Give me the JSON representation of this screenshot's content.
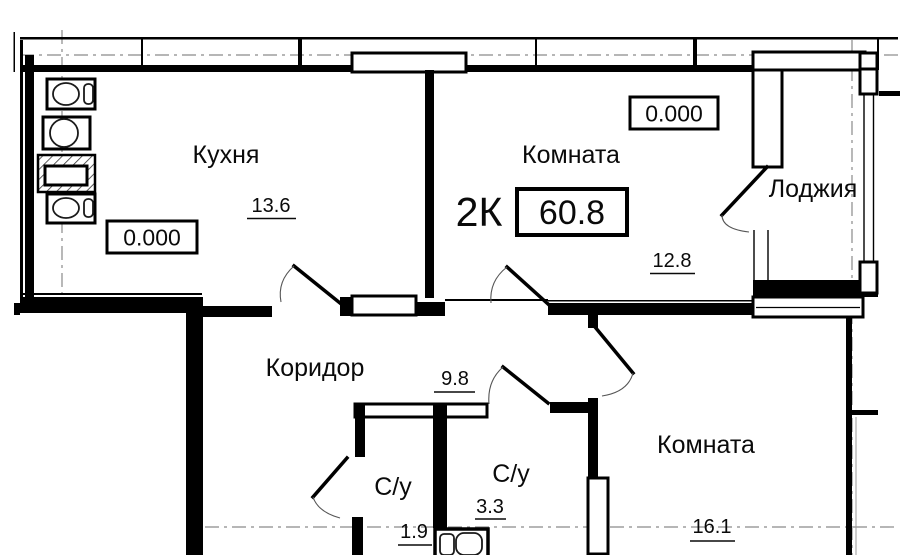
{
  "plan": {
    "scheme_label": "2К",
    "total_area": "60.8",
    "rooms": {
      "kitchen": {
        "name": "Кухня",
        "area": "13.6"
      },
      "room1": {
        "name": "Комната",
        "area": "12.8"
      },
      "loggia": {
        "name": "Лоджия"
      },
      "corridor": {
        "name": "Коридор",
        "area": "9.8"
      },
      "bath_small": {
        "name": "С/у",
        "area": "1.9"
      },
      "bath_big": {
        "name": "С/у",
        "area": "3.3"
      },
      "room2": {
        "name": "Комната",
        "area": "16.1"
      }
    },
    "elevation_kitchen": "0.000",
    "elevation_room1": "0.000",
    "colors": {
      "line": "#000000",
      "axis": "#8a8a8a",
      "background": "#ffffff"
    }
  }
}
